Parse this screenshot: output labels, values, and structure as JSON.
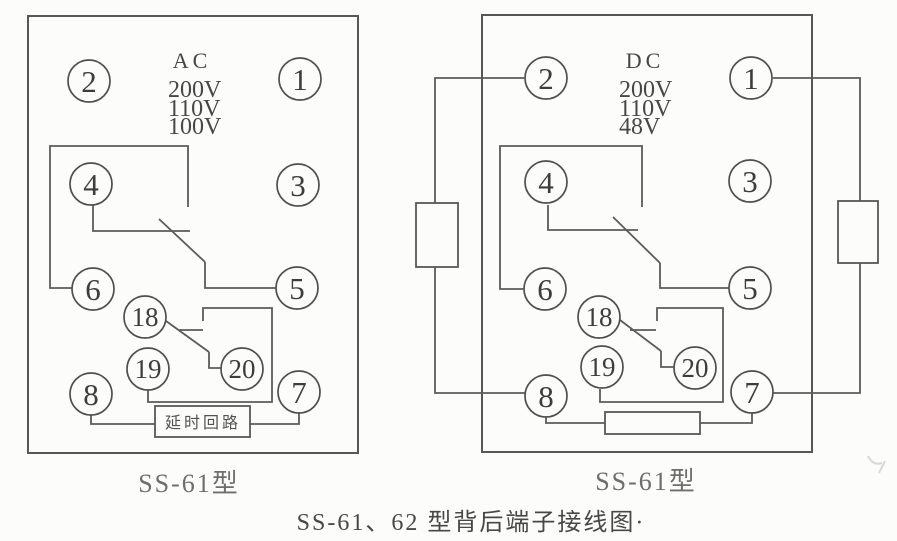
{
  "caption": "SS-61、62 型背后端子接线图·",
  "colors": {
    "line": "#575757",
    "text": "#474747",
    "sublabel": "#6e6e6e",
    "background": "#fcfcfb"
  },
  "diagrams": [
    {
      "name_label": "SS-61型",
      "supply": {
        "type": "AC",
        "voltages": [
          "200V",
          "110V",
          "100V"
        ]
      },
      "terminals": {
        "t2": "2",
        "t1": "1",
        "t4": "4",
        "t3": "3",
        "t6": "6",
        "t5": "5",
        "t18": "18",
        "t19": "19",
        "t20": "20",
        "t8": "8",
        "t7": "7"
      },
      "delay_box_label": "延时回路"
    },
    {
      "name_label": "SS-61型",
      "supply": {
        "type": "DC",
        "voltages": [
          "200V",
          "110V",
          "48V"
        ]
      },
      "terminals": {
        "t2": "2",
        "t1": "1",
        "t4": "4",
        "t3": "3",
        "t6": "6",
        "t5": "5",
        "t18": "18",
        "t19": "19",
        "t20": "20",
        "t8": "8",
        "t7": "7"
      }
    }
  ]
}
